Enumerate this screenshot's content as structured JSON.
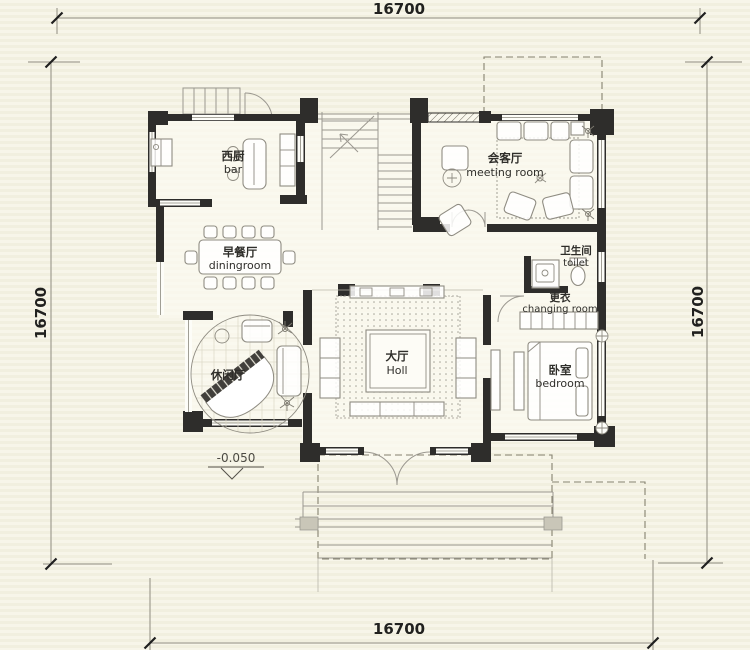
{
  "drawing": {
    "type": "residential floor plan",
    "dimensions": {
      "top": "16700",
      "bottom": "16700",
      "left": "16700",
      "right": "16700"
    },
    "elevation_marker": "-0.050",
    "rooms": {
      "bar": {
        "zh": "西厨",
        "en": "bar"
      },
      "dining": {
        "zh": "早餐厅",
        "en": "diningroom"
      },
      "leisure": {
        "zh": "休闲厅",
        "en": ""
      },
      "hall": {
        "zh": "大厅",
        "en": "Holl"
      },
      "meeting": {
        "zh": "会客厅",
        "en": "meeting room"
      },
      "toilet": {
        "zh": "卫生间",
        "en": "toilet"
      },
      "changing": {
        "zh": "更衣",
        "en": "changing room"
      },
      "bedroom": {
        "zh": "卧室",
        "en": "bedroom"
      }
    },
    "colors": {
      "background": "#f5f3e6",
      "wall": "#2e2d2b",
      "line": "#9b9890",
      "text": "#2f2e2a"
    }
  }
}
